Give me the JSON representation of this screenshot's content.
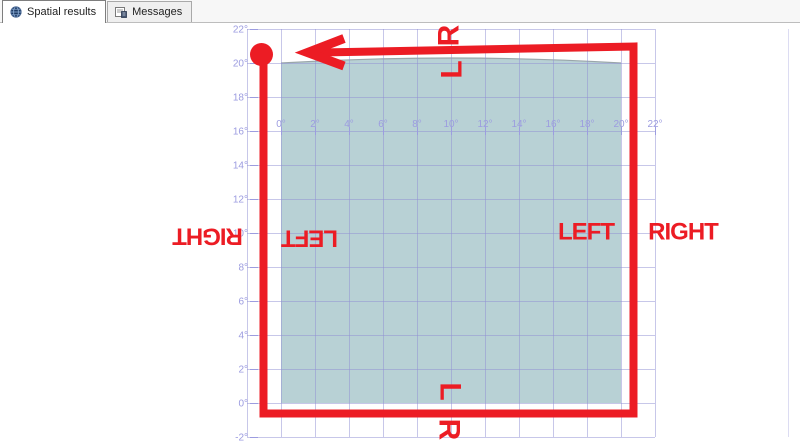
{
  "tabs": [
    {
      "label": "Spatial results",
      "icon": "globe-icon",
      "active": true
    },
    {
      "label": "Messages",
      "icon": "messages-icon",
      "active": false
    }
  ],
  "chart_data": {
    "type": "spatial-polygon",
    "title": "",
    "x_axis": {
      "tick_values": [
        0,
        2,
        4,
        6,
        8,
        10,
        12,
        14,
        16,
        18,
        20,
        22
      ],
      "tick_labels": [
        "0°",
        "2°",
        "4°",
        "6°",
        "8°",
        "10°",
        "12°",
        "14°",
        "16°",
        "18°",
        "20°",
        "22°"
      ],
      "label_row_at_y_value": 16
    },
    "y_axis": {
      "tick_values": [
        22,
        20,
        18,
        16,
        14,
        12,
        10,
        8,
        6,
        4,
        2,
        0,
        -2
      ],
      "tick_labels": [
        "22°",
        "20°",
        "18°",
        "16°",
        "14°",
        "12°",
        "10°",
        "8°",
        "6°",
        "4°",
        "2°",
        "0°",
        "-2°"
      ]
    },
    "grid": {
      "x_range": [
        -2,
        22
      ],
      "y_range": [
        -2,
        22
      ],
      "step": 2,
      "grid_on": true,
      "line_color": "#8f8fd4",
      "label_color": "#9c9ce0",
      "right_border_color": "#dcdcf2"
    },
    "polygon": {
      "coords_deg": [
        [
          0,
          0
        ],
        [
          20,
          0
        ],
        [
          20,
          20
        ],
        [
          0,
          20
        ]
      ],
      "fill": "#8db5bb",
      "fill_opacity": 0.62,
      "top_edge_outline": "#9aa6aa",
      "top_edge_bulge_px": 10
    },
    "annotations": {
      "color": "#ec1c24",
      "ring_px": {
        "left": 263.5,
        "right": 633.5,
        "top_left_y": 52.5,
        "top_right_y": 46.5,
        "bottom": 413.5,
        "stroke_width": 8
      },
      "start_marker_px": {
        "x": 261.5,
        "y": 54.5,
        "radius": 11.5
      },
      "arrow_px": {
        "tip_x": 307.5,
        "tip_y": 52.5,
        "barb_x": 344,
        "barb_top_y": 38.5,
        "barb_bottom_y": 66,
        "stroke_width": 9
      },
      "labels": [
        {
          "text": "R",
          "x": 449,
          "y": 36,
          "rotation": -90,
          "size": 30
        },
        {
          "text": "L",
          "x": 452,
          "y": 70,
          "rotation": -90,
          "size": 30
        },
        {
          "text": "RIGHT",
          "x": 208,
          "y": 236,
          "rotation": 180,
          "size": 24
        },
        {
          "text": "LEFT",
          "x": 310,
          "y": 238,
          "rotation": 180,
          "size": 24
        },
        {
          "text": "LEFT",
          "x": 586,
          "y": 232,
          "rotation": 0,
          "size": 24
        },
        {
          "text": "RIGHT",
          "x": 683,
          "y": 232,
          "rotation": 0,
          "size": 24
        },
        {
          "text": "L",
          "x": 450,
          "y": 391,
          "rotation": 90,
          "size": 30
        },
        {
          "text": "R",
          "x": 449,
          "y": 429,
          "rotation": 90,
          "size": 30
        }
      ]
    }
  }
}
